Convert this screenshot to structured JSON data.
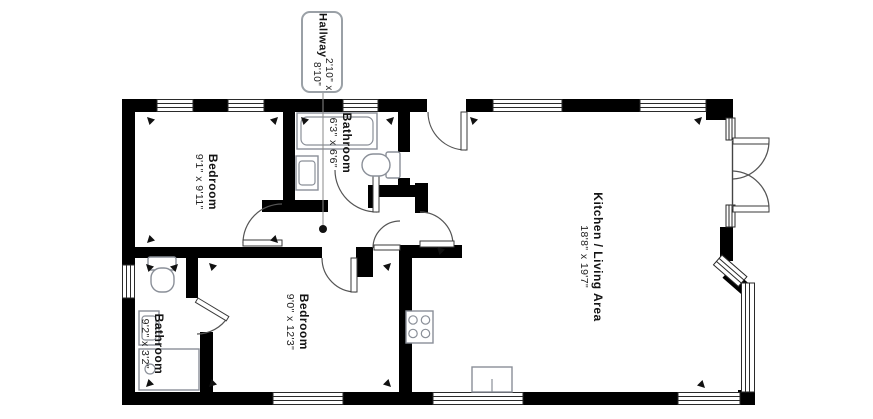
{
  "plan": {
    "callout": {
      "name": "Hallway",
      "dims": "2'10\" x 8'10\""
    },
    "rooms": [
      {
        "id": "bedroom-1",
        "name": "Bedroom",
        "dims": "9'1\" x 9'11\""
      },
      {
        "id": "bathroom-1",
        "name": "Bathroom",
        "dims": "6'3\" x 6'6\""
      },
      {
        "id": "kitchen-living",
        "name": "Kitchen / Living Area",
        "dims": "18'8\" x 19'7\""
      },
      {
        "id": "bedroom-2",
        "name": "Bedroom",
        "dims": "9'0\" x 12'3\""
      },
      {
        "id": "bathroom-2",
        "name": "Bathroom",
        "dims": "9'2\" x 3'2\""
      }
    ],
    "colors": {
      "wall": "#000000",
      "fixture_stroke": "#8a8f98",
      "door_stroke": "#555555",
      "callout_border": "#9aa0a6",
      "background": "#ffffff"
    }
  }
}
